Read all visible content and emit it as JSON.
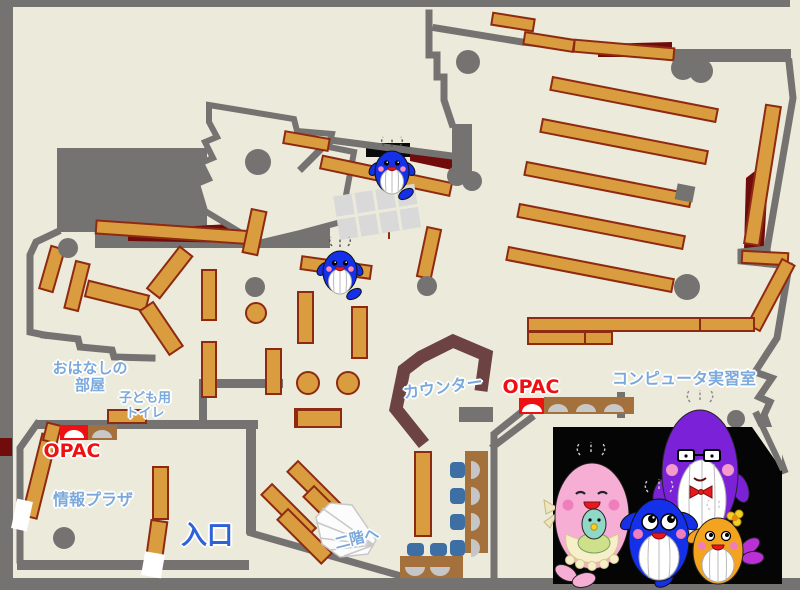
{
  "labels": {
    "storytime_room": "おはなしの\n部屋",
    "kids_toilet": "子ども用\nトイレ",
    "opac_left": "OPAC",
    "info_plaza": "情報プラザ",
    "entrance": "入口",
    "counter": "カウンター",
    "opac_right": "OPAC",
    "computer_room": "コンピュータ実習室",
    "to_second_floor": "二階へ"
  },
  "colors": {
    "floor": "#ECEADA",
    "wall_gray": "#757371",
    "shelf": "#D99C3E",
    "shelf_border": "#8F2A12",
    "dark_red_accent": "#700C0C",
    "counter_brown": "#6C4242",
    "desk_brown": "#A4713C",
    "chair_blue": "#3D6FA5",
    "opac_red": "#EE1111",
    "label_blue": "#7CA9DB",
    "entrance_blue": "#2F62D9",
    "photo_background": "#050505"
  },
  "mascots": {
    "map_whales": "blue whale mascot (appears twice on the floor)",
    "family": [
      "pink mother whale holding teal baby whale, wearing apron",
      "blue child whale",
      "purple father whale with glasses and red bow tie",
      "orange child whale with yellow flower"
    ]
  }
}
